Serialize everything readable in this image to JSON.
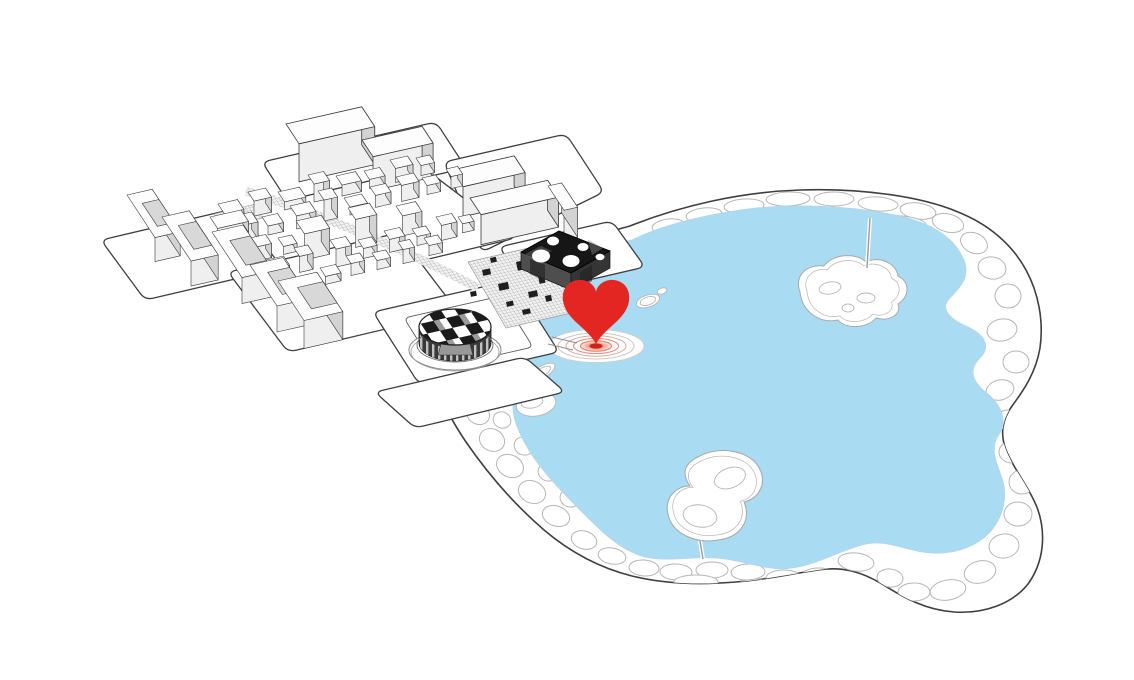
{
  "meta": {
    "description": "axonometric-site-diagram-with-heart-location-marker",
    "visible_text": "none"
  },
  "colors": {
    "water": "#a9dbf3",
    "water-edge": "#b9d4e4",
    "line-dark": "#3f3f3f",
    "line-light": "#b6b6b6",
    "top-fill": "#fdfdfd",
    "front-fill": "#efefef",
    "side-fill": "#d3d3d3",
    "court-fill": "#d8d8d8",
    "heart": "#e32621",
    "dark-top": "#161616",
    "dark-side": "#4e4e4e",
    "dark-side2": "#353535",
    "drum-dark": "#3a3a3a",
    "hatch": "#909090"
  },
  "marker": {
    "kind": "heart-pin-with-ripple",
    "heart_d": "M596,344 C588,328 566,320 563,301 C561,286 572,279 582,280 C590,281 595,286 596,292 C597,286 602,281 610,280 C620,279 631,286 629,301 C626,320 604,328 596,344 Z",
    "ripple_rings": 4,
    "center": [
      596,
      346
    ]
  },
  "park": {
    "boundary_d": "M630,226 C680,206 740,192 800,190 C860,188 920,196 958,212 C988,224 1012,244 1026,270 C1038,292 1044,320 1040,348 C1036,372 1024,390 1012,406 C1002,420 1000,434 1006,450 C1014,470 1030,488 1038,510 C1046,534 1044,562 1028,584 C1012,604 984,614 954,612 C926,610 904,598 882,584 C862,572 842,566 818,570 C790,574 764,580 736,582 C700,585 664,584 632,576 C600,568 570,552 544,530 C514,504 488,474 466,442 C450,418 440,400 444,388 C448,376 462,366 478,352 C494,338 508,322 518,308 C526,296 534,280 546,266 C558,252 584,238 630,226 Z",
    "water_d": "M632,240 C660,226 700,216 740,210 C790,203 850,205 900,216 C930,223 952,236 962,256 C972,274 962,286 950,298 C940,308 948,318 966,326 C984,334 992,346 980,358 C968,370 972,382 988,394 C1002,406 1008,422 998,436 C990,448 996,462 1002,478 C1008,496 1004,518 988,534 C972,550 946,556 922,552 C900,548 884,540 866,544 C840,550 820,564 792,568 C768,572 744,560 716,558 C688,556 660,564 636,554 C616,546 600,530 584,514 C566,496 544,474 530,452 C518,432 510,414 514,398 C518,384 532,380 528,366 C524,354 510,350 514,336 C518,324 534,322 532,310 C530,298 518,296 524,284 C530,272 548,272 552,262 C556,252 550,246 558,240 C570,230 600,248 632,240 Z",
    "cells": [
      [
        668,
        226,
        16,
        7,
        -8
      ],
      [
        704,
        215,
        18,
        7,
        -6
      ],
      [
        744,
        206,
        20,
        7,
        -4
      ],
      [
        788,
        199,
        22,
        7,
        -2
      ],
      [
        834,
        199,
        20,
        7,
        0
      ],
      [
        878,
        204,
        20,
        7,
        4
      ],
      [
        918,
        211,
        18,
        8,
        8
      ],
      [
        948,
        223,
        16,
        9,
        14
      ],
      [
        974,
        243,
        14,
        10,
        24
      ],
      [
        992,
        268,
        14,
        11,
        10
      ],
      [
        1008,
        296,
        13,
        12,
        0
      ],
      [
        1002,
        330,
        15,
        11,
        -10
      ],
      [
        1016,
        362,
        13,
        11,
        0
      ],
      [
        1000,
        390,
        14,
        10,
        -14
      ],
      [
        1008,
        420,
        12,
        10,
        0
      ],
      [
        1012,
        452,
        13,
        11,
        0
      ],
      [
        1022,
        482,
        13,
        12,
        0
      ],
      [
        1018,
        514,
        14,
        12,
        0
      ],
      [
        1004,
        546,
        15,
        12,
        -8
      ],
      [
        980,
        572,
        16,
        11,
        -14
      ],
      [
        948,
        590,
        18,
        10,
        -10
      ],
      [
        914,
        592,
        16,
        9,
        0
      ],
      [
        890,
        578,
        13,
        9,
        6
      ],
      [
        856,
        562,
        18,
        9,
        6
      ],
      [
        820,
        576,
        18,
        8,
        2
      ],
      [
        784,
        578,
        18,
        8,
        0
      ],
      [
        748,
        572,
        17,
        8,
        -2
      ],
      [
        712,
        570,
        16,
        8,
        0
      ],
      [
        676,
        572,
        16,
        8,
        2
      ],
      [
        644,
        568,
        15,
        8,
        4
      ],
      [
        612,
        556,
        14,
        8,
        10
      ],
      [
        584,
        540,
        13,
        9,
        16
      ],
      [
        556,
        516,
        14,
        10,
        20
      ],
      [
        532,
        492,
        14,
        11,
        24
      ],
      [
        510,
        466,
        14,
        11,
        26
      ],
      [
        492,
        440,
        13,
        11,
        28
      ],
      [
        478,
        414,
        12,
        10,
        30
      ],
      [
        486,
        396,
        10,
        8,
        20
      ],
      [
        502,
        420,
        9,
        8,
        24
      ],
      [
        524,
        446,
        10,
        9,
        22
      ],
      [
        548,
        472,
        10,
        9,
        20
      ],
      [
        570,
        498,
        10,
        9,
        18
      ],
      [
        560,
        268,
        10,
        7,
        -30
      ],
      [
        548,
        292,
        9,
        7,
        -20
      ],
      [
        540,
        318,
        8,
        6,
        -16
      ],
      [
        536,
        344,
        8,
        6,
        0
      ],
      [
        524,
        368,
        9,
        7,
        10
      ],
      [
        760,
        586,
        24,
        7,
        0
      ],
      [
        696,
        582,
        22,
        7,
        0
      ],
      [
        902,
        222,
        24,
        6,
        6
      ],
      [
        648,
        240,
        12,
        6,
        -14
      ]
    ],
    "islands": [
      {
        "name": "island-north",
        "d": "M800,292 C794,276 806,264 824,266 C832,254 856,252 866,262 C878,256 896,262 898,276 C910,282 910,296 898,304 C902,314 890,322 876,318 C868,328 846,330 838,320 C820,324 802,312 800,292 Z",
        "cx": 851,
        "cy": 291,
        "inner_scale": 0.86,
        "blobs": [
          [
            830,
            288,
            11,
            6,
            -10
          ],
          [
            866,
            298,
            9,
            5,
            0
          ],
          [
            848,
            308,
            6,
            4,
            0
          ]
        ]
      },
      {
        "name": "island-south",
        "d": "M700,456 C718,446 748,450 758,466 C768,482 760,498 744,502 C752,520 740,538 718,540 C696,544 672,534 668,514 C664,498 676,486 690,486 C680,472 686,462 700,456 Z",
        "cx": 713,
        "cy": 497,
        "inner_scale": 0.88,
        "blobs": [
          [
            730,
            478,
            16,
            10,
            -20
          ],
          [
            700,
            516,
            17,
            11,
            10
          ]
        ]
      }
    ],
    "small_islands": [
      [
        648,
        301,
        12,
        6,
        -18
      ],
      [
        648,
        301,
        8,
        4,
        -18
      ],
      [
        662,
        291,
        5,
        3,
        -18
      ],
      [
        541,
        373,
        16,
        6,
        -32
      ],
      [
        541,
        373,
        11,
        4,
        -32
      ],
      [
        536,
        404,
        20,
        12,
        -10
      ],
      [
        532,
        402,
        11,
        6,
        -10
      ],
      [
        523,
        352,
        6,
        4,
        0
      ]
    ],
    "bridges": [
      [
        867,
        268,
        870,
        218
      ],
      [
        700,
        541,
        703,
        559
      ]
    ]
  },
  "city": {
    "plates": [
      {
        "name": "plate-top-1",
        "pts": [
          [
            262,
            162
          ],
          [
            436,
            122
          ],
          [
            466,
            168
          ],
          [
            292,
            208
          ]
        ]
      },
      {
        "name": "plate-top-2",
        "pts": [
          [
            444,
            162
          ],
          [
            566,
            134
          ],
          [
            604,
            192
          ],
          [
            482,
            252
          ]
        ]
      },
      {
        "name": "plate-oldtown",
        "pts": [
          [
            204,
            220
          ],
          [
            424,
            168
          ],
          [
            516,
            238
          ],
          [
            296,
            291
          ]
        ]
      },
      {
        "name": "plate-left-1",
        "pts": [
          [
            101,
            240
          ],
          [
            238,
            208
          ],
          [
            282,
            268
          ],
          [
            145,
            300
          ]
        ]
      },
      {
        "name": "plate-left-2",
        "pts": [
          [
            228,
            272
          ],
          [
            398,
            233
          ],
          [
            458,
            312
          ],
          [
            288,
            352
          ]
        ]
      },
      {
        "name": "plate-darkbox",
        "pts": [
          [
            499,
            247
          ],
          [
            612,
            221
          ],
          [
            645,
            267
          ],
          [
            532,
            293
          ]
        ]
      },
      {
        "name": "plate-plaza",
        "pts": [
          [
            373,
            312
          ],
          [
            513,
            280
          ],
          [
            559,
            352
          ],
          [
            419,
            384
          ]
        ]
      },
      {
        "name": "plate-south",
        "pts": [
          [
            375,
            392
          ],
          [
            525,
            357
          ],
          [
            565,
            392
          ],
          [
            415,
            428
          ]
        ]
      }
    ],
    "plaza_inner_pts": [
      [
        404,
        318
      ],
      [
        501,
        296
      ],
      [
        533,
        347
      ],
      [
        436,
        369
      ]
    ],
    "market_d": "M468,262 L546,244 L584,310 L506,328 Z",
    "patch_d": "M214,214 L256,204 L262,218 L220,228 Z",
    "street_d": "M246,191 C320,214 400,247 478,288",
    "market_blobs": [
      [
        482,
        270,
        8,
        6
      ],
      [
        498,
        284,
        10,
        7
      ],
      [
        516,
        262,
        7,
        9
      ],
      [
        528,
        292,
        9,
        6
      ],
      [
        506,
        302,
        7,
        5
      ],
      [
        538,
        276,
        6,
        8
      ],
      [
        553,
        262,
        8,
        5
      ],
      [
        470,
        292,
        6,
        5
      ],
      [
        522,
        310,
        8,
        5
      ],
      [
        545,
        296,
        6,
        6
      ],
      [
        560,
        282,
        7,
        5
      ],
      [
        490,
        258,
        6,
        5
      ]
    ],
    "piers": [
      [
        552,
        337,
        577,
        343
      ],
      [
        548,
        344,
        573,
        350
      ]
    ],
    "buildings": [
      [
        "box",
        286,
        162,
        78,
        26,
        38
      ],
      [
        "box",
        362,
        174,
        62,
        22,
        34
      ],
      [
        "box",
        452,
        200,
        64,
        22,
        30
      ],
      [
        "box",
        470,
        228,
        80,
        22,
        30
      ],
      [
        "box",
        548,
        216,
        14,
        32,
        30
      ],
      [
        "box",
        218,
        214,
        20,
        13,
        10
      ],
      [
        "box",
        248,
        207,
        18,
        12,
        15
      ],
      [
        "box",
        278,
        200,
        22,
        13,
        8
      ],
      [
        "box",
        308,
        193,
        16,
        12,
        18
      ],
      [
        "box",
        336,
        187,
        20,
        12,
        11
      ],
      [
        "box",
        364,
        180,
        16,
        11,
        9
      ],
      [
        "box",
        390,
        174,
        18,
        11,
        14
      ],
      [
        "box",
        416,
        168,
        14,
        10,
        10
      ],
      [
        "box",
        234,
        233,
        18,
        13,
        17
      ],
      [
        "box",
        262,
        226,
        16,
        12,
        9
      ],
      [
        "box",
        290,
        219,
        20,
        13,
        13
      ],
      [
        "box",
        318,
        212,
        14,
        12,
        21
      ],
      [
        "box",
        344,
        206,
        18,
        12,
        8
      ],
      [
        "box",
        370,
        199,
        16,
        11,
        12
      ],
      [
        "box",
        396,
        193,
        18,
        11,
        16
      ],
      [
        "box",
        422,
        187,
        14,
        10,
        9
      ],
      [
        "box",
        446,
        181,
        12,
        10,
        12
      ],
      [
        "box",
        296,
        247,
        26,
        17,
        26
      ],
      [
        "box",
        348,
        236,
        22,
        15,
        28
      ],
      [
        "box",
        396,
        226,
        20,
        13,
        20
      ],
      [
        "box",
        250,
        252,
        16,
        12,
        14
      ],
      [
        "box",
        278,
        246,
        14,
        11,
        8
      ],
      [
        "box",
        330,
        258,
        16,
        12,
        18
      ],
      [
        "box",
        358,
        250,
        14,
        11,
        10
      ],
      [
        "box",
        384,
        244,
        16,
        11,
        13
      ],
      [
        "box",
        412,
        238,
        14,
        10,
        9
      ],
      [
        "box",
        436,
        232,
        16,
        11,
        15
      ],
      [
        "box",
        458,
        226,
        12,
        9,
        9
      ],
      [
        "box",
        266,
        270,
        18,
        12,
        10
      ],
      [
        "box",
        294,
        264,
        14,
        11,
        16
      ],
      [
        "box",
        320,
        276,
        16,
        11,
        8
      ],
      [
        "box",
        346,
        268,
        14,
        10,
        12
      ],
      [
        "box",
        372,
        262,
        14,
        10,
        9
      ],
      [
        "box",
        398,
        256,
        12,
        10,
        14
      ],
      [
        "box",
        424,
        248,
        14,
        10,
        10
      ],
      [
        "box",
        210,
        228,
        32,
        15,
        11
      ],
      [
        "c",
        127,
        219,
        26,
        56,
        24
      ],
      [
        "c",
        162,
        242,
        28,
        58,
        25
      ],
      [
        "c",
        212,
        258,
        32,
        60,
        26
      ],
      [
        "c",
        250,
        291,
        34,
        54,
        26
      ],
      [
        "c",
        278,
        309,
        40,
        52,
        28
      ]
    ]
  }
}
